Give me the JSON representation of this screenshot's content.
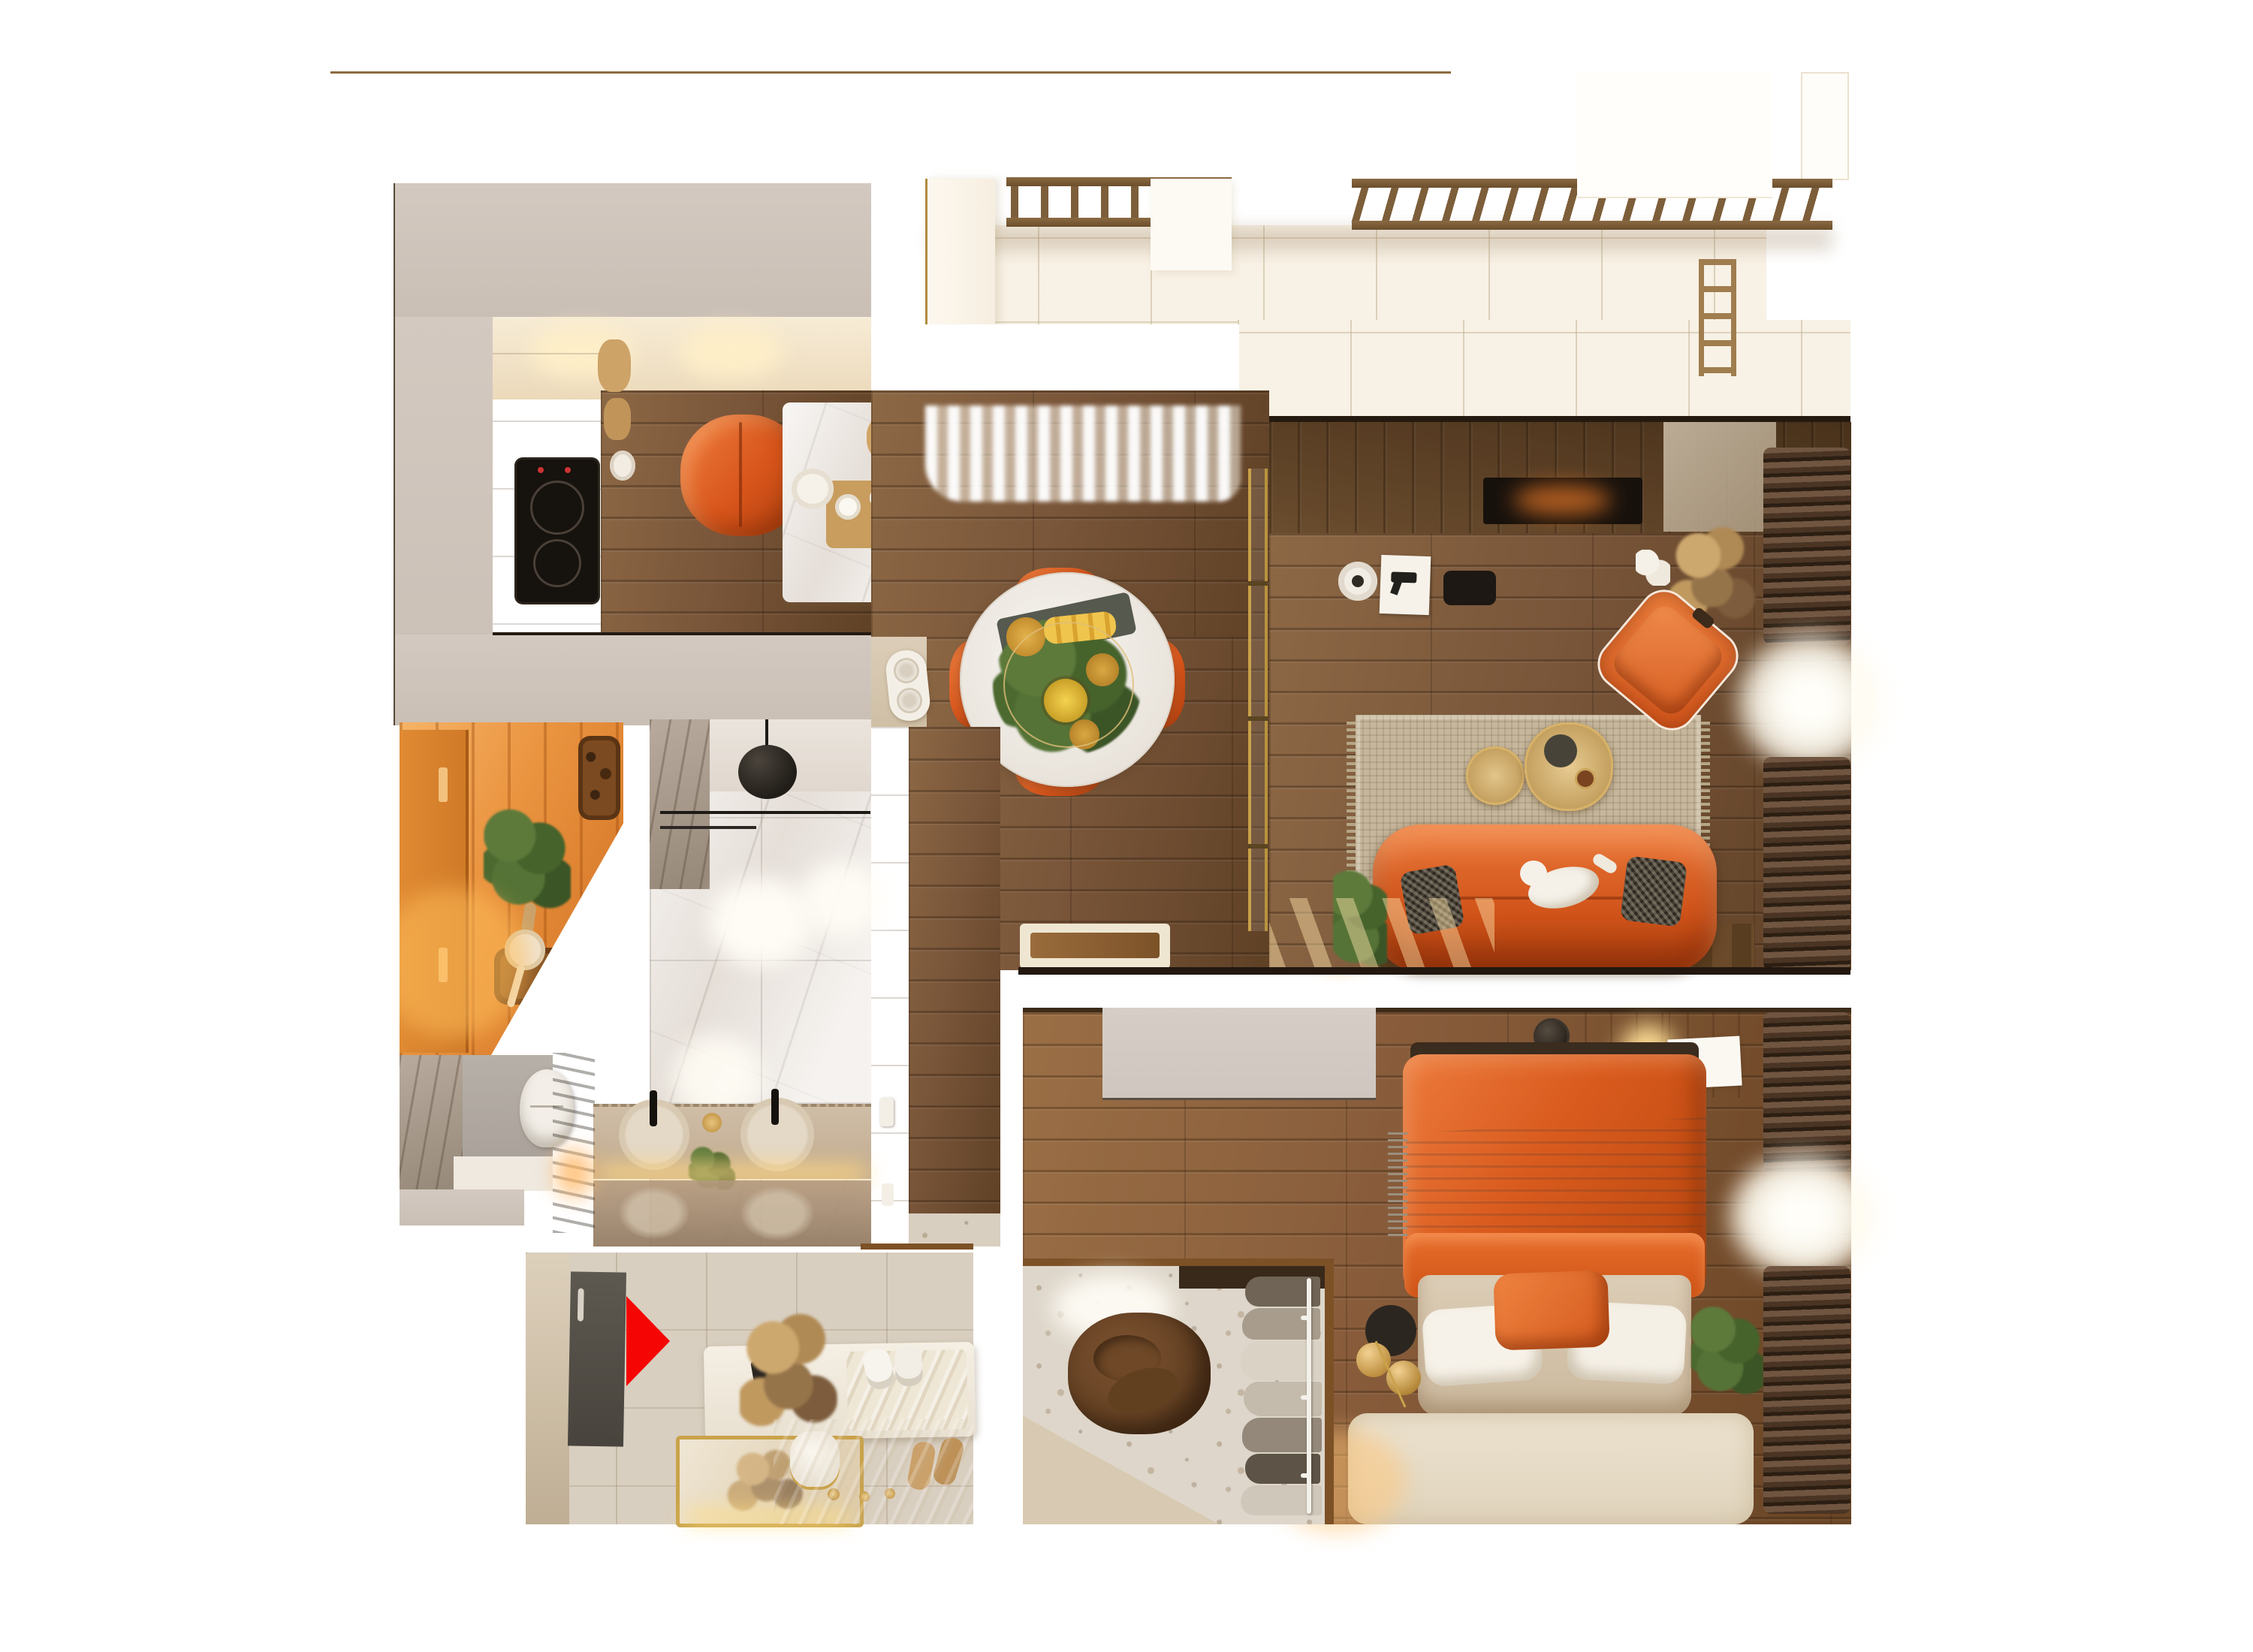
{
  "scene": {
    "type": "photorealistic top-down 3D floor plan render",
    "view": "top-down",
    "background": "#ffffff",
    "style": "warm wood apartment with orange accents, no visible text labels"
  },
  "palette": {
    "background": "#ffffff",
    "wood_floor": "#7c5938",
    "wood_wall": "#5f4327",
    "taupe_wall": "#cfc5bb",
    "balcony_floor": "#f8f1e5",
    "sauna_wood": "#e9953f",
    "marble_white": "#ece6e0",
    "marble_gray": "#ab9d90",
    "terrazzo": "#d9cfc0",
    "rug_living": "#c6b79c",
    "rug_bedroom": "#e7ddca",
    "accent_orange": "#d8571c",
    "curtain_brown": "#4c3826",
    "gold": "#c9a24a",
    "arrow_red": "#f60505",
    "plant_green": "#4e6b33",
    "cooktop_black": "#16120e"
  },
  "markers": {
    "entrance_arrow": {
      "color": "#f60505",
      "meaning": "entrance direction marker",
      "points": "right"
    }
  },
  "rooms": [
    {
      "name": "balcony",
      "features": [
        "wood railing segments",
        "light terrazzo floor",
        "small ladder"
      ]
    },
    {
      "name": "kitchen",
      "features": [
        "black induction cooktop",
        "orange chair",
        "marble breakfast table",
        "wood floor"
      ]
    },
    {
      "name": "dining-area",
      "features": [
        "round marble table with pineapples",
        "four orange chairs",
        "sheer curtains",
        "gold glass partition",
        "white speaker"
      ]
    },
    {
      "name": "living-room",
      "features": [
        "orange sofa with white cat",
        "houndstooth pillows",
        "woven rug",
        "gold coffee tables",
        "orange lounge chair",
        "media wall with revolver artwork",
        "dried plant",
        "brown curtains with sunlit sheer"
      ]
    },
    {
      "name": "sauna",
      "features": [
        "glowing cedar planks",
        "birch whisk",
        "wooden bucket with ladle",
        "stone heater"
      ]
    },
    {
      "name": "bathroom",
      "features": [
        "white marble tiles",
        "black pendant lamp",
        "glass shower partition",
        "double round sinks",
        "black faucets",
        "backlit vanity"
      ]
    },
    {
      "name": "wc",
      "features": [
        "gray marble wall",
        "wall-hung toilet"
      ]
    },
    {
      "name": "corridor",
      "features": [
        "wood plank floor",
        "light switches"
      ]
    },
    {
      "name": "entry-hall",
      "features": [
        "red entrance arrow",
        "dark door mat",
        "white console with dried flowers",
        "gold floor mirror",
        "sneakers",
        "slippers",
        "hat box"
      ]
    },
    {
      "name": "walk-in-closet",
      "features": [
        "brown bean bag",
        "clothes rack with stacked garments",
        "terrazzo floor"
      ]
    },
    {
      "name": "bedroom",
      "features": [
        "bed with orange duvet and gray throw",
        "white pillows and orange pillow",
        "wood feature wall",
        "nightstand with glowing lamp",
        "gray wardrobe",
        "gold sphere lamp",
        "cream rug",
        "brown curtains with sunlit sheer",
        "plant"
      ]
    }
  ]
}
